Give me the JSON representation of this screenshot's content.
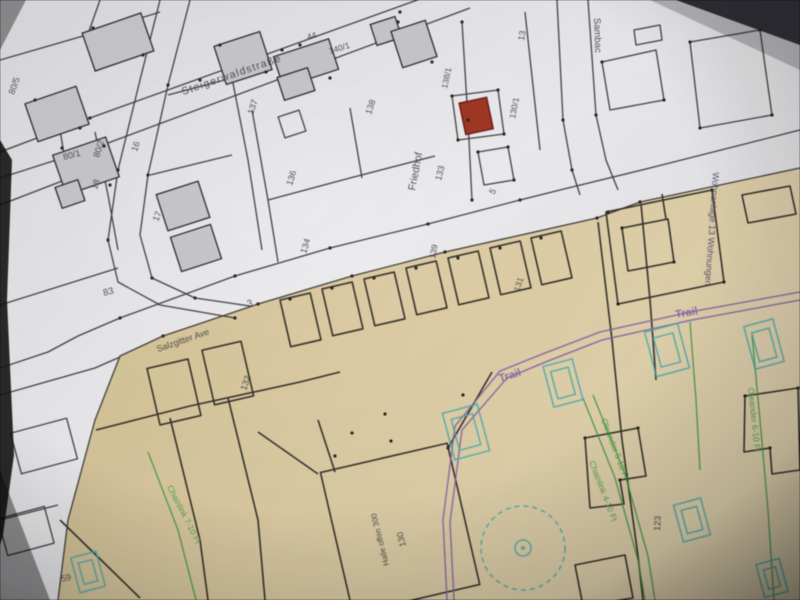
{
  "map": {
    "colors": {
      "ink": "#3b3b3e",
      "purple": "#8e5fae",
      "green": "#3d9e3d",
      "navy": "#474460",
      "teal": "#3fb0b2",
      "red_building_fill": "#a9331f",
      "red_building_stroke": "#6e1d10",
      "paper_gray": "#ebebee",
      "tan_area": "#e0cda0",
      "building_gray": "#c9c9cd",
      "line_ink": "#2e2e30"
    },
    "labels": [
      {
        "text": "Steigerwaldstraße",
        "x": 183,
        "y": 95,
        "rot": -19,
        "size": 10.5,
        "color": "ink",
        "ls": 1.2,
        "kind": "street"
      },
      {
        "text": "Sambac",
        "x": 594,
        "y": 18,
        "rot": 88,
        "size": 9.5,
        "color": "ink",
        "kind": "street"
      },
      {
        "text": "Salzgitter Ave",
        "x": 158,
        "y": 352,
        "rot": -19,
        "size": 9,
        "color": "ink",
        "kind": "street"
      },
      {
        "text": "80/5",
        "x": 14,
        "y": 95,
        "rot": -70,
        "size": 9,
        "color": "ink",
        "kind": "parcel"
      },
      {
        "text": "80/1",
        "x": 64,
        "y": 160,
        "rot": -15,
        "size": 9,
        "color": "ink",
        "kind": "parcel"
      },
      {
        "text": "80/2",
        "x": 99,
        "y": 158,
        "rot": -73,
        "size": 9,
        "color": "ink",
        "kind": "parcel"
      },
      {
        "text": "18",
        "x": 97,
        "y": 190,
        "rot": -73,
        "size": 9,
        "color": "ink",
        "kind": "parcel"
      },
      {
        "text": "16",
        "x": 137,
        "y": 152,
        "rot": -73,
        "size": 9,
        "color": "ink",
        "kind": "parcel"
      },
      {
        "text": "17",
        "x": 158,
        "y": 222,
        "rot": -68,
        "size": 9,
        "color": "ink",
        "kind": "parcel"
      },
      {
        "text": "83",
        "x": 104,
        "y": 296,
        "rot": -15,
        "size": 9.5,
        "color": "ink",
        "kind": "parcel"
      },
      {
        "text": "3",
        "x": 248,
        "y": 307,
        "rot": -15,
        "size": 9.5,
        "color": "ink",
        "kind": "parcel"
      },
      {
        "text": "137",
        "x": 253,
        "y": 115,
        "rot": -71,
        "size": 9,
        "color": "ink",
        "kind": "parcel"
      },
      {
        "text": "44",
        "x": 308,
        "y": 40,
        "rot": -17,
        "size": 8.5,
        "color": "ink",
        "kind": "parcel"
      },
      {
        "text": "140/1",
        "x": 330,
        "y": 54,
        "rot": -17,
        "size": 8.5,
        "color": "ink",
        "kind": "parcel"
      },
      {
        "text": "138",
        "x": 371,
        "y": 115,
        "rot": -72,
        "size": 9,
        "color": "ink",
        "kind": "parcel"
      },
      {
        "text": "136",
        "x": 292,
        "y": 186,
        "rot": -73,
        "size": 9,
        "color": "ink",
        "kind": "parcel"
      },
      {
        "text": "134",
        "x": 306,
        "y": 254,
        "rot": -73,
        "size": 9,
        "color": "ink",
        "kind": "parcel"
      },
      {
        "text": "13",
        "x": 524,
        "y": 41,
        "rot": -80,
        "size": 9,
        "color": "ink",
        "kind": "parcel"
      },
      {
        "text": "138/1",
        "x": 447,
        "y": 89,
        "rot": -78,
        "size": 8.5,
        "color": "ink",
        "kind": "parcel"
      },
      {
        "text": "130/1",
        "x": 515,
        "y": 119,
        "rot": -79,
        "size": 8.5,
        "color": "ink",
        "kind": "parcel"
      },
      {
        "text": "5",
        "x": 494,
        "y": 195,
        "rot": -60,
        "size": 9,
        "color": "ink",
        "kind": "parcel"
      },
      {
        "text": "133",
        "x": 441,
        "y": 181,
        "rot": -76,
        "size": 9,
        "color": "ink",
        "kind": "parcel"
      },
      {
        "text": "Friedhof",
        "x": 415,
        "y": 191,
        "rot": -79,
        "size": 10.5,
        "color": "ink",
        "kind": "street"
      },
      {
        "text": "132",
        "x": 246,
        "y": 391,
        "rot": -71,
        "size": 9,
        "color": "ink",
        "kind": "parcel"
      },
      {
        "text": "139",
        "x": 435,
        "y": 259,
        "rot": -79,
        "size": 8.5,
        "color": "ink",
        "kind": "parcel"
      },
      {
        "text": "131",
        "x": 519,
        "y": 292,
        "rot": -71,
        "size": 8.5,
        "color": "ink",
        "kind": "parcel"
      },
      {
        "text": "130",
        "x": 406,
        "y": 546,
        "rot": -104,
        "size": 9,
        "color": "ink",
        "kind": "parcel"
      },
      {
        "text": "Halle offen 300",
        "x": 389,
        "y": 565,
        "rot": -104,
        "size": 8,
        "color": "ink",
        "kind": "parcel"
      },
      {
        "text": "123",
        "x": 660,
        "y": 531,
        "rot": -87,
        "size": 9,
        "color": "ink",
        "kind": "parcel"
      },
      {
        "text": "59",
        "x": 62,
        "y": 582,
        "rot": -15,
        "size": 9,
        "color": "ink",
        "kind": "parcel"
      },
      {
        "text": "Trail",
        "x": 676,
        "y": 318,
        "rot": -10,
        "size": 11,
        "color": "purple",
        "bold": true,
        "kind": "overlay"
      },
      {
        "text": "Trail",
        "x": 500,
        "y": 382,
        "rot": -17,
        "size": 11,
        "color": "purple",
        "bold": true,
        "kind": "overlay"
      },
      {
        "text": "Wohnanlage 13 Wohnungen",
        "x": 713,
        "y": 172,
        "rot": 94,
        "size": 9,
        "color": "navy",
        "kind": "overlay"
      },
      {
        "text": "Oleander 5-10 Ft",
        "x": 601,
        "y": 420,
        "rot": 69,
        "size": 8.5,
        "color": "green",
        "kind": "overlay"
      },
      {
        "text": "Chainlink 4-10 Ft",
        "x": 589,
        "y": 462,
        "rot": 69,
        "size": 8.5,
        "color": "green",
        "kind": "overlay"
      },
      {
        "text": "Oleander 6-10 Ft",
        "x": 748,
        "y": 388,
        "rot": 84,
        "size": 8.5,
        "color": "green",
        "kind": "overlay"
      },
      {
        "text": "Chainlink 7-10 Ft",
        "x": 167,
        "y": 487,
        "rot": 63,
        "size": 8.5,
        "color": "green",
        "kind": "overlay"
      }
    ]
  }
}
